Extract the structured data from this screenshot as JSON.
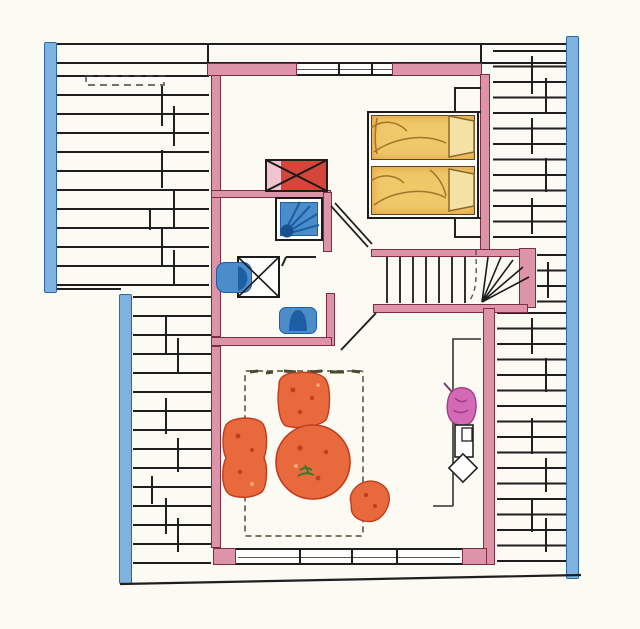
{
  "drawing": {
    "kind": "hand-drawn attic floor plan, top view, colored pencil style",
    "rooms": [
      {
        "name": "bedroom"
      },
      {
        "name": "bathroom"
      },
      {
        "name": "hallway"
      },
      {
        "name": "staircase"
      },
      {
        "name": "living-room"
      }
    ],
    "fixtures": [
      {
        "name": "chimney",
        "symbol": "red rectangle with diagonal cross"
      },
      {
        "name": "shower",
        "symbol": "blue square with corner drain fan"
      },
      {
        "name": "washbasin",
        "symbol": "blue basin on crossed cabinet"
      },
      {
        "name": "toilet",
        "symbol": "blue bowl against wall"
      }
    ],
    "furniture": [
      {
        "name": "double-bed",
        "detail": "two mattresses with pillows"
      },
      {
        "name": "armchair"
      },
      {
        "name": "sofa"
      },
      {
        "name": "round-table",
        "detail": "green plant sprig on top"
      },
      {
        "name": "side-chair",
        "detail": "rotated"
      },
      {
        "name": "floor-plant",
        "detail": "magenta"
      },
      {
        "name": "sideboard"
      },
      {
        "name": "rug",
        "detail": "dashed outline"
      }
    ],
    "structure": [
      {
        "name": "roof-hatching-left-upper"
      },
      {
        "name": "roof-hatching-left-lower"
      },
      {
        "name": "roof-hatching-right"
      },
      {
        "name": "gable-beam-left"
      },
      {
        "name": "gable-beam-left-lower"
      },
      {
        "name": "gable-beam-right"
      },
      {
        "name": "north-window"
      },
      {
        "name": "south-window-band"
      },
      {
        "name": "roof-window",
        "symbol": "dashed rectangle in hatching"
      },
      {
        "name": "bedroom-door"
      },
      {
        "name": "bathroom-door"
      },
      {
        "name": "living-room-door"
      },
      {
        "name": "winder-stairs",
        "detail": "straight treads plus fanned winders"
      }
    ]
  },
  "colors": {
    "paper": "#fbfaf3",
    "ink": "#1f1f1f",
    "wall_fill": "#dd93a8",
    "wall_edge": "#7e2d44",
    "beam_blue_fill": "#7db3de",
    "beam_blue_edge": "#2f66a3",
    "fixture_blue": "#4a8dca",
    "fixture_blue_dark": "#1d5fa3",
    "chimney_red": "#d6453a",
    "chimney_light": "#efc3cf",
    "bed_yellow": "#eec869",
    "bed_orange_edge": "#e09a3a",
    "pillow": "#f4e1a4",
    "sketch_brown": "#a3742a",
    "furniture_orange": "#e8693c",
    "furniture_dark": "#c23c1d",
    "furniture_light": "#f5a678",
    "plant_magenta": "#d36ab5",
    "plant_dark": "#a53c88",
    "leaf_green": "#3a7a28",
    "rug_dot": "#6b6b52"
  }
}
